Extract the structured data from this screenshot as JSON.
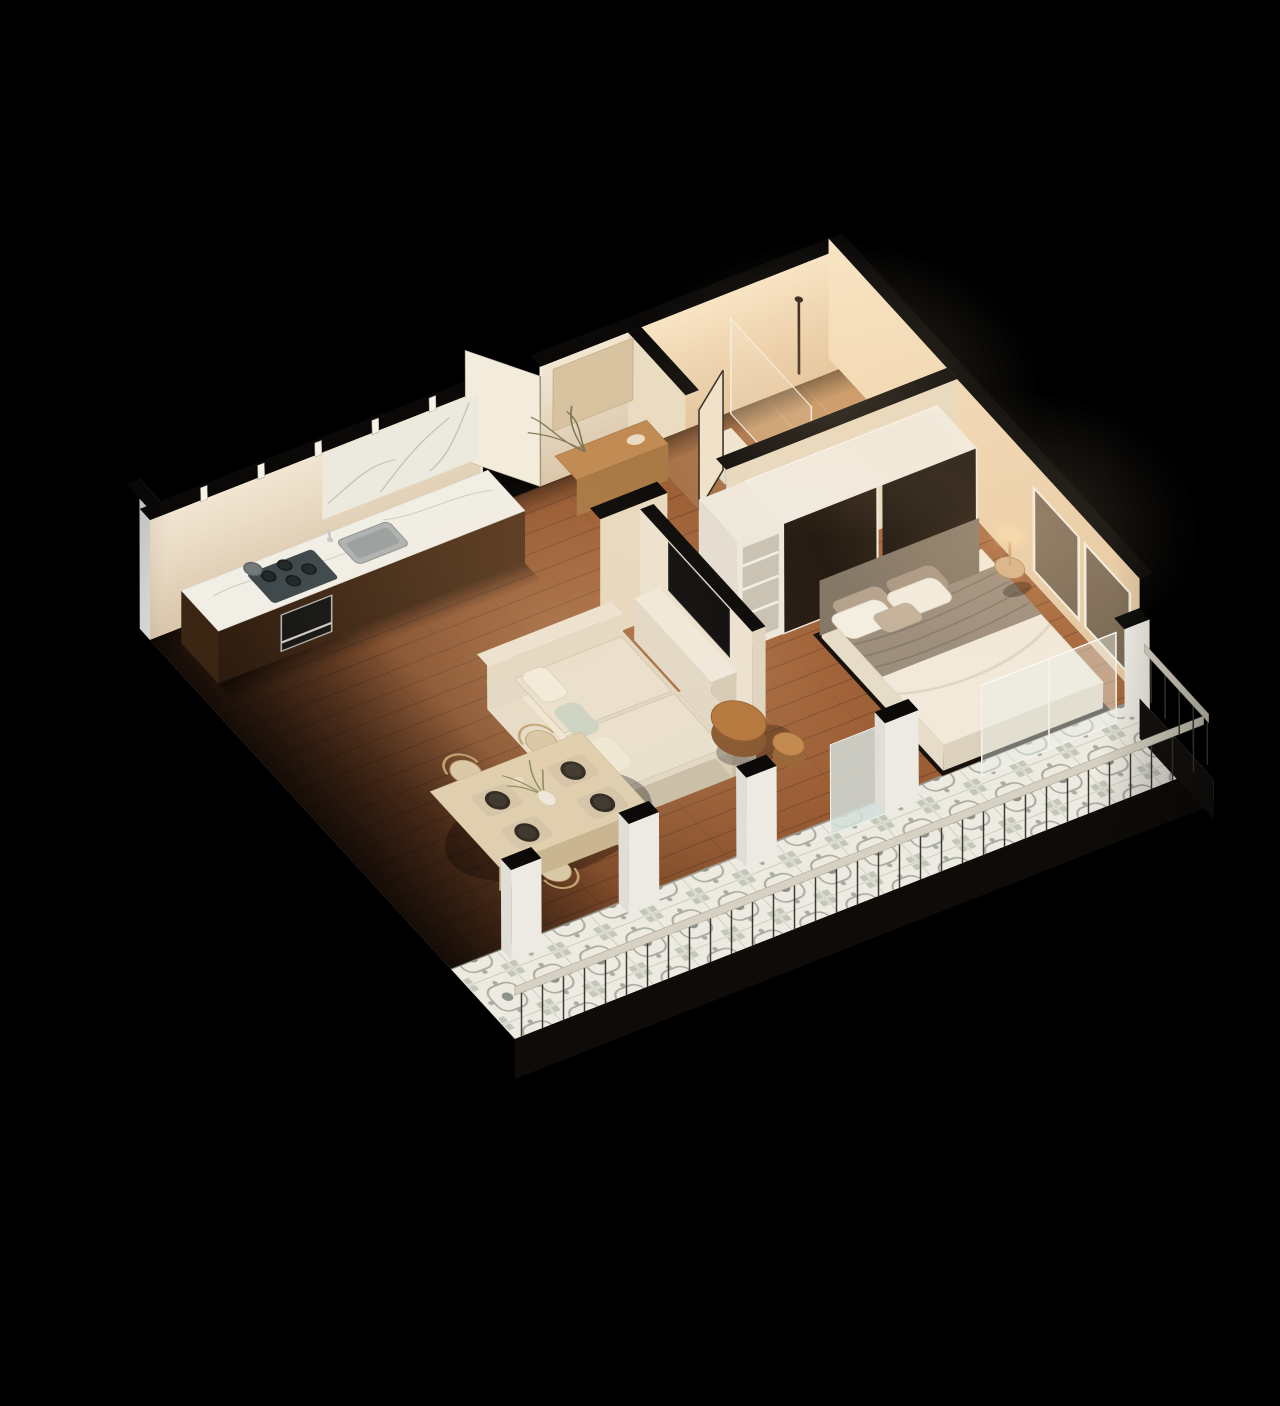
{
  "meta": {
    "description": "Isometric 3D cutaway floor plan render of a one-bedroom apartment on a black background",
    "view": "isometric-3d-floor-plan",
    "canvas": {
      "width": 1280,
      "height": 1406
    }
  },
  "colors": {
    "background": "#000000",
    "wallCapBlack": "#0a0908",
    "woodDark": "#6b3f24",
    "woodMid": "#95572f",
    "woodLight": "#a86a3e",
    "bathFloor": "#a9744a",
    "showerFloor": "#c2915f",
    "tileBase": "#edeae1",
    "tileMotif": "#a9ada1",
    "tileMotifDark": "#8e9289",
    "facadeLight": "#f0efec",
    "facadeDark": "#9fa4a2",
    "wallCreamLight": "#f2e6d2",
    "wallCreamDark": "#d9c6aa",
    "wallWarmLight": "#f8e4c4",
    "wallWarmDark": "#e2c49e",
    "hallWallShade": "#e9dcc2",
    "counterWalnutDark": "#2c1b0e",
    "counterWalnutLight": "#5a3a20",
    "marbleTop": "#f1eee6",
    "marbleVein": "#c2beb2",
    "sinkSteel": "#aeb2b1",
    "hobDark": "#3e484b",
    "ovenBlack": "#161616",
    "ovenSteel": "#b7b2a8",
    "wardrobeDoorA": "#261b12",
    "wardrobeDoorB": "#1d150e",
    "carcassWhite": "#f0ebe1",
    "sofaCream": "#e2d8c4",
    "sofaBack": "#e6dcc8",
    "cushion": "#e9e0cd",
    "pillowSage": "#ccd3c3",
    "bedBase": "#17100b",
    "bedDuvet": "#f2e9da",
    "bedBlanket": "#9d8e7d",
    "bedHeadboard": "#857867",
    "pillowWhite": "#f4eee1",
    "pillowTaupe": "#b5a28d",
    "tableAsh": "#e0cfae",
    "chairTan": "#d9c8a6",
    "chairArc": "#c2a473",
    "plateDark": "#332d25",
    "matBeige": "#d6c5a8",
    "consoleWood": "#c08a52",
    "plantGreen": "#7d7757",
    "lampShade": "#f2d9ad",
    "tvBlack": "#0d0d0d",
    "glassFrost": "#d3dedb",
    "glassClear": "#e9efe9",
    "railPost": "#3c3a35",
    "railTop": "#d6d1c2",
    "fasciaDark": "#0e0b08",
    "slabLight": "#dedcd5",
    "toiletWhite": "#f7f3ea",
    "basinCream": "#eedfc6",
    "fixtureBronze": "#332418",
    "nightstandWood": "#d7b288"
  },
  "scene": {
    "rooms": [
      {
        "name": "kitchen",
        "items": [
          "counter",
          "marble-backsplash",
          "sink",
          "gas-hob",
          "pot",
          "oven",
          "wall-clips"
        ]
      },
      {
        "name": "entry",
        "items": [
          "open-front-door",
          "console-niche",
          "dried-plant",
          "bowl"
        ]
      },
      {
        "name": "bathroom",
        "items": [
          "walk-in-shower",
          "glass-screen",
          "hand-shower",
          "toilet",
          "stool-blocks",
          "round-basin",
          "open-door"
        ]
      },
      {
        "name": "bedroom",
        "items": [
          "double-bed",
          "headboard",
          "blanket",
          "pillows",
          "sliding-wardrobe",
          "open-shelf-unit",
          "nightstand",
          "mushroom-lamp",
          "window-wall"
        ]
      },
      {
        "name": "living",
        "items": [
          "sofa-with-chaise",
          "scatter-cushions",
          "nesting-coffee-tables",
          "tv-wall",
          "tv-console",
          "tv"
        ]
      },
      {
        "name": "dining",
        "items": [
          "table",
          "four-chairs",
          "four-place-settings",
          "vase-with-plant"
        ]
      },
      {
        "name": "balcony",
        "items": [
          "patterned-tile-floor",
          "metal-railing",
          "glass-slider",
          "frosted-panel",
          "pillars"
        ]
      }
    ],
    "counts": {
      "dining_chairs": 4,
      "place_settings": 4,
      "bed_pillows": 5,
      "railing_posts": 33,
      "wardrobe_panels": 2,
      "coffee_tables": 2
    }
  }
}
